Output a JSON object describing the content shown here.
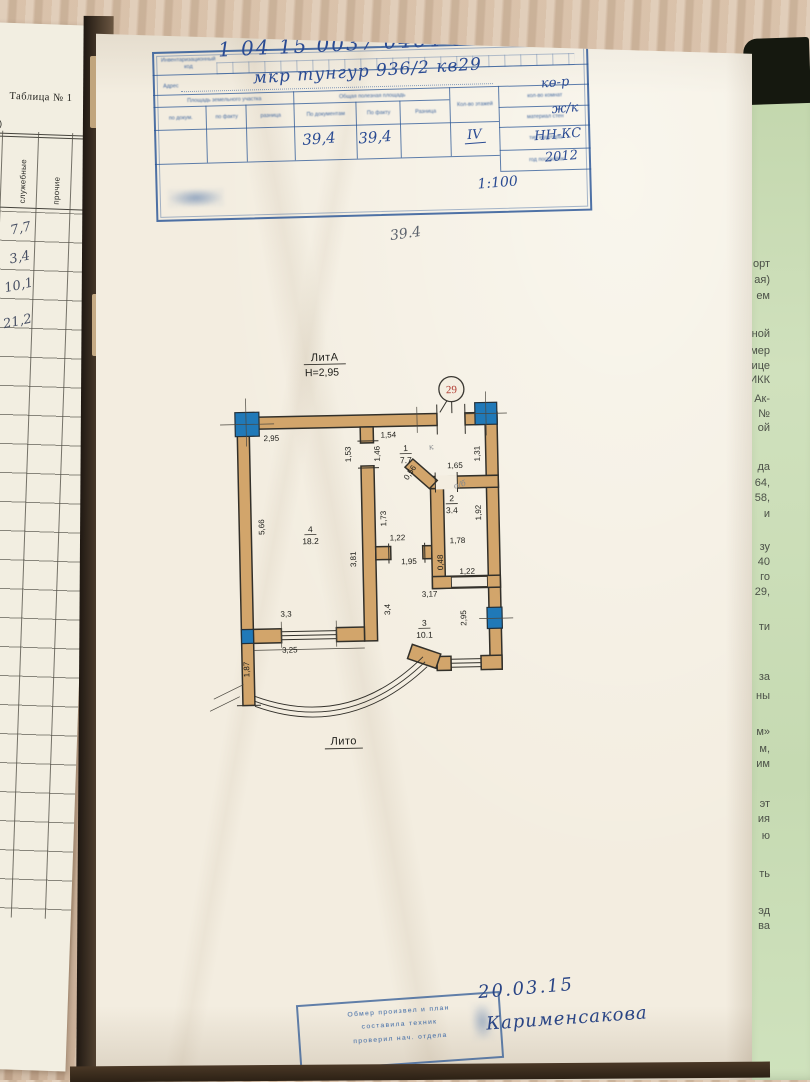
{
  "left_page": {
    "table_title": "Таблица № 1",
    "partial_text": "м.)",
    "col_headers": [
      "культ-быт.",
      "служебные",
      "прочие"
    ],
    "values": [
      "7,7",
      "3,4",
      "10,1",
      "21,2"
    ]
  },
  "stamp": {
    "code_label": "Инвентаризационный код",
    "code": "1 04 15 0037 0464 01 029",
    "address_label": "Адрес",
    "address": "мкр тунгур 936/2 кв29",
    "group1": "Площадь земельного участка",
    "group2": "Общая полезная площадь",
    "cols": [
      "по докум.",
      "по факту",
      "разница",
      "По документам",
      "По факту",
      "Разница",
      "Кол-во этажей"
    ],
    "val_doc": "39,4",
    "val_fact": "39,4",
    "floors": "IV",
    "side_rows": [
      {
        "label": "кол-во комнат",
        "value": "кө-р"
      },
      {
        "label": "материал стен",
        "value": "ж/к"
      },
      {
        "label": "тип квартиры",
        "value": "НН-КС"
      },
      {
        "label": "год постройки",
        "value": "2012"
      }
    ],
    "scale": "1:100"
  },
  "pencil_note": "39.4",
  "plan": {
    "litera_top": "ЛитА",
    "height": "Н=2,95",
    "unit_number": "29",
    "litera_bottom": "Лито",
    "rooms": [
      {
        "num": "1",
        "area": "7.7",
        "x": 213,
        "y": 104
      },
      {
        "num": "2",
        "area": "3.4",
        "x": 258,
        "y": 155
      },
      {
        "num": "3",
        "area": "10.1",
        "x": 228,
        "y": 279
      },
      {
        "num": "4",
        "area": "18.2",
        "x": 116,
        "y": 183
      }
    ],
    "dims": [
      {
        "t": "2,95",
        "x": 79,
        "y": 91
      },
      {
        "t": "1,54",
        "x": 196,
        "y": 90
      },
      {
        "t": "1,53",
        "x": 158,
        "y": 106,
        "r": -90
      },
      {
        "t": "1,46",
        "x": 187,
        "y": 106,
        "r": -90
      },
      {
        "t": "1,65",
        "x": 262,
        "y": 122
      },
      {
        "t": "1,31",
        "x": 287,
        "y": 108,
        "r": -90
      },
      {
        "t": "0,56",
        "x": 219,
        "y": 127,
        "r": -55
      },
      {
        "t": "1,92",
        "x": 287,
        "y": 167,
        "r": -90
      },
      {
        "t": "1,78",
        "x": 263,
        "y": 197
      },
      {
        "t": "1,73",
        "x": 192,
        "y": 171,
        "r": -90
      },
      {
        "t": "1,22",
        "x": 203,
        "y": 193
      },
      {
        "t": "1,95",
        "x": 214,
        "y": 217
      },
      {
        "t": "5,66",
        "x": 70,
        "y": 177,
        "r": -90
      },
      {
        "t": "3,81",
        "x": 161,
        "y": 211,
        "r": -90
      },
      {
        "t": "0,48",
        "x": 248,
        "y": 216,
        "r": -90
      },
      {
        "t": "1,22",
        "x": 272,
        "y": 228
      },
      {
        "t": "3,17",
        "x": 234,
        "y": 250
      },
      {
        "t": "3,4",
        "x": 194,
        "y": 262,
        "r": -90
      },
      {
        "t": "2,95",
        "x": 270,
        "y": 272,
        "r": -90
      },
      {
        "t": "3,3",
        "x": 90,
        "y": 267
      },
      {
        "t": "3,25",
        "x": 93,
        "y": 303
      },
      {
        "t": "1,87",
        "x": 52,
        "y": 319,
        "r": -90
      }
    ],
    "pencil_marks": [
      {
        "t": "к",
        "x": 239,
        "y": 103,
        "r": -10
      },
      {
        "t": "о/б",
        "x": 267,
        "y": 141,
        "r": -15
      }
    ]
  },
  "bottom_stamp": {
    "lines": [
      "Обмер произвел и план",
      "составила техник",
      "проверил нач. отдела"
    ]
  },
  "signature": {
    "date": "20.03.15",
    "name": "Карименсакова"
  },
  "right_page": {
    "fragments": [
      {
        "t": "орт",
        "y": 192
      },
      {
        "t": "ая)",
        "y": 208
      },
      {
        "t": "ем",
        "y": 224
      },
      {
        "t": "ной",
        "y": 262
      },
      {
        "t": "мер",
        "y": 279
      },
      {
        "t": "ице",
        "y": 294
      },
      {
        "t": "ИКК",
        "y": 308
      },
      {
        "t": "Ак-",
        "y": 327
      },
      {
        "t": "№",
        "y": 342
      },
      {
        "t": "ой",
        "y": 356
      },
      {
        "t": "да",
        "y": 395
      },
      {
        "t": "64,",
        "y": 411
      },
      {
        "t": "58,",
        "y": 426
      },
      {
        "t": "и",
        "y": 442
      },
      {
        "t": "зу",
        "y": 475
      },
      {
        "t": "40",
        "y": 490
      },
      {
        "t": "го",
        "y": 505
      },
      {
        "t": "29,",
        "y": 520
      },
      {
        "t": "ти",
        "y": 555
      },
      {
        "t": "за",
        "y": 605
      },
      {
        "t": "ны",
        "y": 624
      },
      {
        "t": "м»",
        "y": 660
      },
      {
        "t": "м,",
        "y": 677
      },
      {
        "t": "им",
        "y": 692
      },
      {
        "t": "эт",
        "y": 732
      },
      {
        "t": "ия",
        "y": 747
      },
      {
        "t": "ю",
        "y": 764
      },
      {
        "t": "ть",
        "y": 802
      },
      {
        "t": "эд",
        "y": 839
      },
      {
        "t": "ва",
        "y": 854
      }
    ]
  }
}
